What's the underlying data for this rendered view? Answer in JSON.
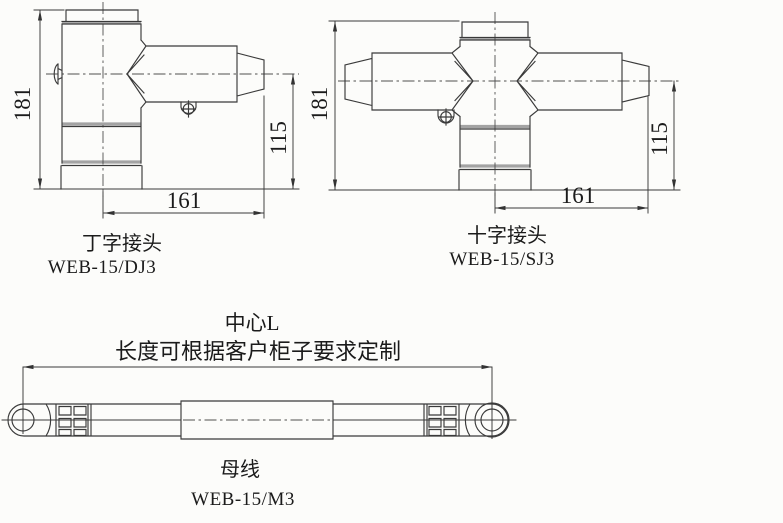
{
  "colors": {
    "background": "#fcfcfa",
    "line": "#3a3a3a",
    "band": "#a3a3a3",
    "centerline": "#4f4f4f",
    "text": "#1b1b1b"
  },
  "t_joint": {
    "caption": "丁字接头",
    "model": "WEB-15/DJ3",
    "dim_height": "181",
    "dim_branch": "115",
    "dim_width": "161"
  },
  "cross_joint": {
    "caption": "十字接头",
    "model": "WEB-15/SJ3",
    "dim_height": "181",
    "dim_branch": "115",
    "dim_width": "161"
  },
  "busbar": {
    "caption": "母线",
    "model": "WEB-15/M3",
    "center_label": "中心L",
    "length_note": "长度可根据客户柜子要求定制"
  }
}
